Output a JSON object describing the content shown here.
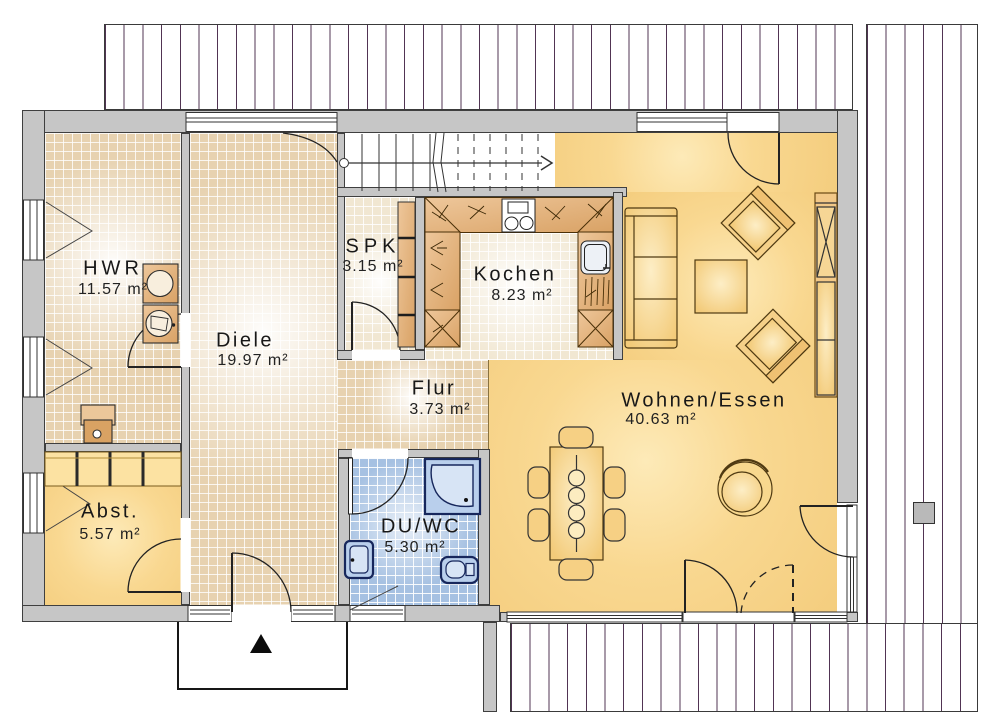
{
  "plan": {
    "type": "floor-plan",
    "rooms": [
      {
        "name": "HWR",
        "area": "11.57 m²"
      },
      {
        "name": "Diele",
        "area": "19.97 m²"
      },
      {
        "name": "SPK",
        "area": "3.15 m²"
      },
      {
        "name": "Kochen",
        "area": "8.23 m²"
      },
      {
        "name": "Flur",
        "area": "3.73 m²"
      },
      {
        "name": "Abst.",
        "area": "5.57 m²"
      },
      {
        "name": "DU/WC",
        "area": "5.30 m²"
      },
      {
        "name": "Wohnen/Essen",
        "area": "40.63 m²"
      }
    ],
    "colors": {
      "wall": "#c6c6c6",
      "wall_outline": "#3f3f3f",
      "floor_beige": "#e7d2b0",
      "floor_yellow": "#f9d891",
      "floor_tile_blue": "#a6c1e2",
      "floor_kitchen": "#f1e7d2",
      "counter_wood": "#e0b182",
      "fixture_blue": "#b9cfec",
      "deck_line": "#3e1e40"
    }
  }
}
